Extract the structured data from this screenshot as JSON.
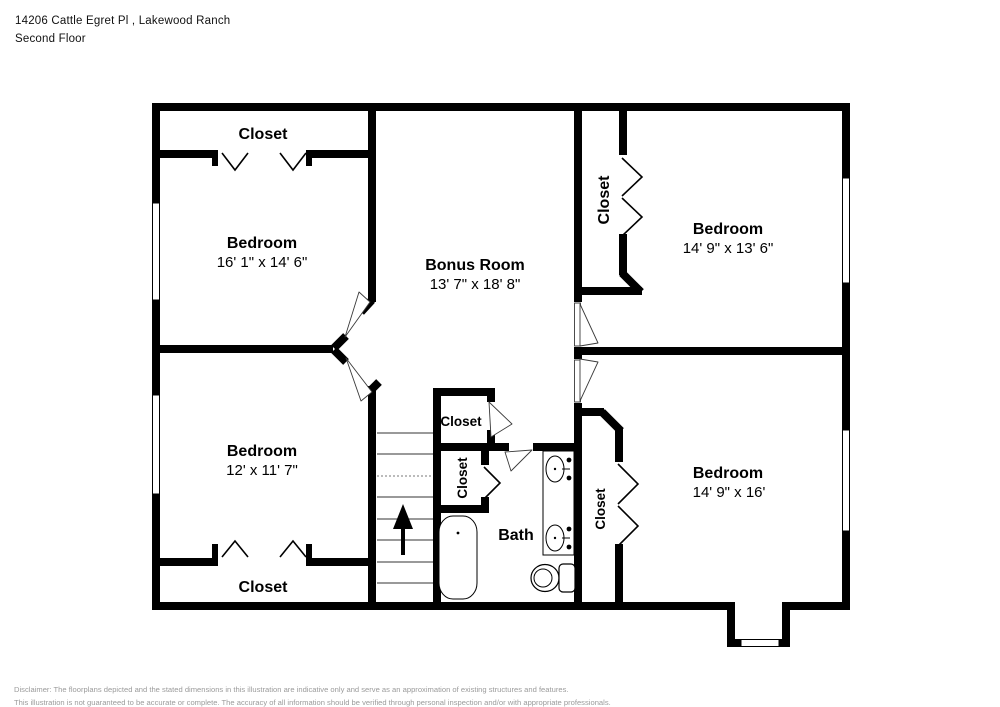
{
  "header": {
    "address": "14206 Cattle Egret Pl , Lakewood Ranch",
    "floor": "Second Floor"
  },
  "rooms": {
    "closet_top_left": {
      "label": "Closet"
    },
    "bedroom_top_left": {
      "label": "Bedroom",
      "dims": "16' 1\" x 14' 6\""
    },
    "bonus_room": {
      "label": "Bonus Room",
      "dims": "13' 7\" x 18' 8\""
    },
    "closet_top_right": {
      "label": "Closet"
    },
    "bedroom_top_right": {
      "label": "Bedroom",
      "dims": "14' 9\" x 13' 6\""
    },
    "bedroom_bottom_left": {
      "label": "Bedroom",
      "dims": "12' x 11' 7\""
    },
    "closet_bottom_left": {
      "label": "Closet"
    },
    "closet_hall": {
      "label": "Closet"
    },
    "closet_mid": {
      "label": "Closet"
    },
    "bath": {
      "label": "Bath"
    },
    "closet_bottom_right": {
      "label": "Closet"
    },
    "bedroom_bottom_right": {
      "label": "Bedroom",
      "dims": "14' 9\" x 16'"
    }
  },
  "disclaimer": {
    "line1": "Disclaimer: The floorplans depicted and the stated dimensions in this illustration are indicative only and serve as an approximation of existing structures and features.",
    "line2": "This illustration is not guaranteed to be accurate or complete. The accuracy of all information should be verified through personal inspection and/or with appropriate professionals."
  },
  "colors": {
    "wall": "#000000",
    "background": "#ffffff",
    "disclaimer_text": "#9b9b9b"
  }
}
